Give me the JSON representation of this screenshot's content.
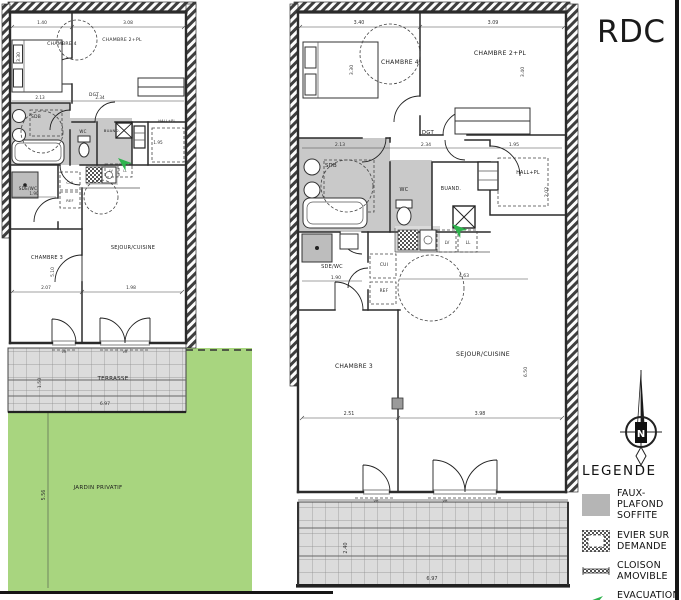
{
  "page": {
    "floor_label": "RDC"
  },
  "compass": {
    "north_label": "N"
  },
  "legend": {
    "title": "LEGENDE",
    "items": [
      {
        "label1": "FAUX-PLAFOND",
        "label2": "SOFFITE"
      },
      {
        "label1": "EVIER SUR",
        "label2": "DEMANDE"
      },
      {
        "label1": "CLOISON",
        "label2": "AMOVIBLE"
      },
      {
        "label1": "EVACUATION",
        "label2": "LL/LV"
      }
    ]
  },
  "left_plan": {
    "rooms": {
      "chambre4": "CHAMBRE 4",
      "chambre2": "CHAMBRE 2+PL",
      "dgt": "DGT",
      "sdb": "SDB",
      "wc": "WC",
      "buand": "BUAND.",
      "hall": "HALL+PL",
      "sdewc": "SDE/WC",
      "cui": "CUI",
      "ref": "REF",
      "lv": "LV",
      "ll": "LL",
      "chambre3": "CHAMBRE 3",
      "sejour": "SEJOUR/CUISINE",
      "terrasse": "TERRASSE",
      "jardin": "JARDIN PRIVATIF",
      "vr": "VR"
    },
    "dims": {
      "top1": "1.40",
      "top2": "3.08",
      "left_v": "3.30",
      "sdb": "2.13",
      "dgt": "2.34",
      "hall": "1.95",
      "sdewc": "1.90",
      "chambre3_w": "2.07",
      "sejour_w": "1.98",
      "chambre3_h": "5.10",
      "terrasse_w": "6.97",
      "terrasse_h": "1.50",
      "jardin_h": "5.56"
    }
  },
  "right_plan": {
    "rooms": {
      "chambre4": "CHAMBRE 4",
      "chambre2": "CHAMBRE 2+PL",
      "dgt": "DGT",
      "sdb": "SDB",
      "wc": "WC",
      "buand": "BUAND.",
      "hall": "HALL+PL",
      "sdewc": "SDE/WC",
      "cui": "CUI",
      "ref": "REF",
      "lv": "LV",
      "ll": "LL",
      "chambre3": "CHAMBRE 3",
      "sejour": "SEJOUR/CUISINE",
      "terrasse": "TERRASSE",
      "vr": "VR"
    },
    "dims": {
      "top1": "3.40",
      "top2": "3.09",
      "chambre4_v": "3.30",
      "chambre2_v": "3.40",
      "sdb": "2.13",
      "dgt": "2.34",
      "hall": "1.95",
      "hall_v": "2.02",
      "sdewc": "1.90",
      "kitchen_w": "4.63",
      "chambre3_w": "2.51",
      "sejour_w": "3.98",
      "sejour_v": "6.50",
      "terrasse_w": "6.97",
      "terrasse_h": "2.40"
    }
  }
}
